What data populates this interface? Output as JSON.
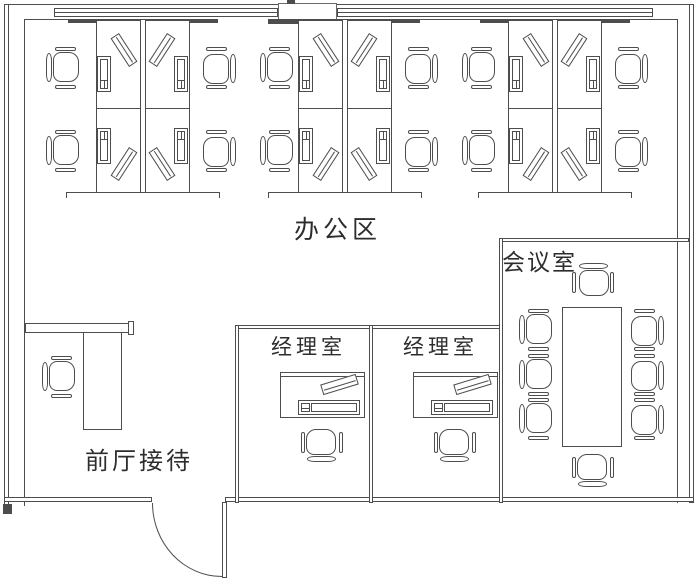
{
  "title": "office-floor-plan",
  "colors": {
    "line": "#4d4d4d",
    "background": "#ffffff",
    "text": "#2d2d2d"
  },
  "rooms": {
    "office_area": {
      "label": "办公区"
    },
    "meeting_room": {
      "label": "会议室"
    },
    "manager_room_1": {
      "label": "经理室"
    },
    "manager_room_2": {
      "label": "经理室"
    },
    "reception": {
      "label": "前厅接待"
    }
  }
}
